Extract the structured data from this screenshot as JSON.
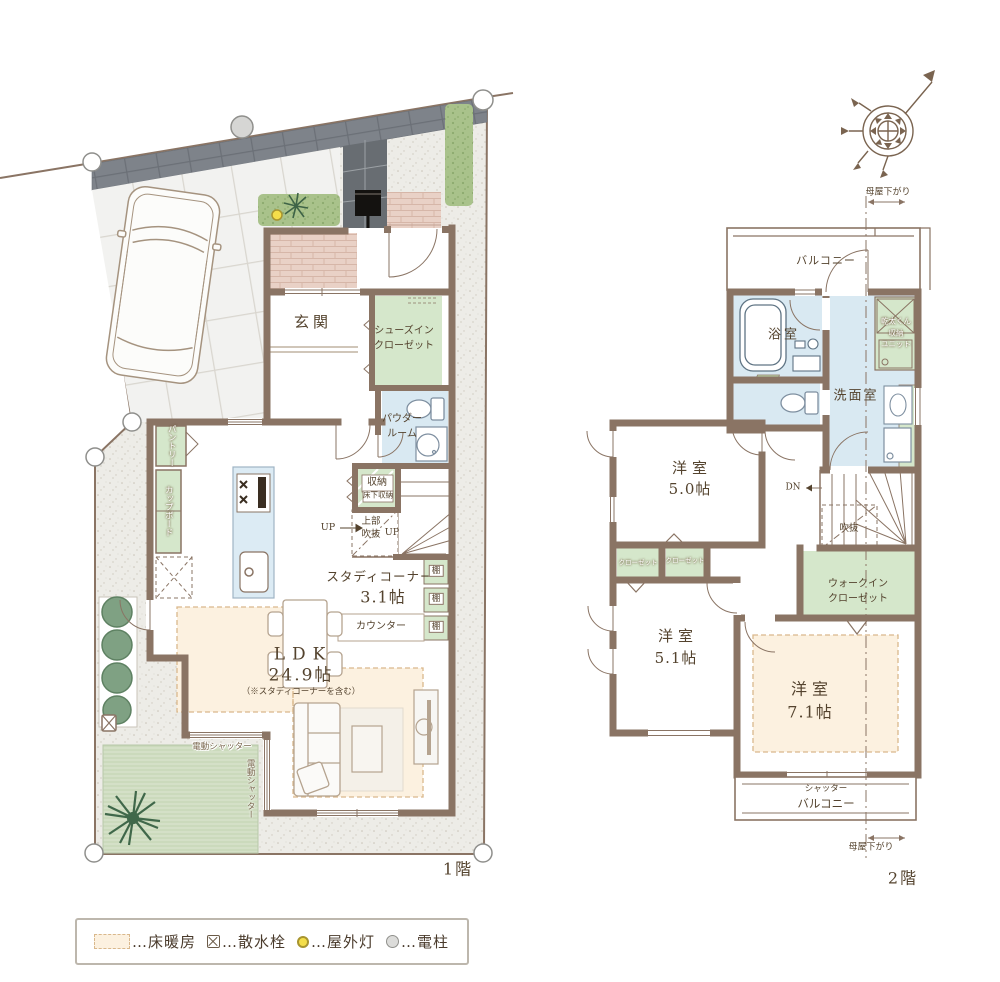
{
  "floor1": {
    "floor_label": "1階",
    "rooms": {
      "genkan": "玄関",
      "shoes_in_closet": "シューズイン\nクローゼット",
      "powder_room": "パウダー\nルーム",
      "storage": "収納",
      "underfloor_storage": "床下収納",
      "upper_void": "上部\n吹抜",
      "up": "UP",
      "study_corner": "スタディコーナー",
      "study_size": "3.1帖",
      "counter": "カウンター",
      "shelf": "棚",
      "pantry": "パントリー",
      "cupboard": "カップボード",
      "ldk": "LDK",
      "ldk_size": "24.9帖",
      "ldk_note": "（※スタディコーナーを含む）",
      "electric_shutter": "電動シャッター"
    }
  },
  "floor2": {
    "floor_label": "2階",
    "rooms": {
      "balcony": "バルコニー",
      "bathroom": "浴室",
      "dryer_unit": "乾太くん\n収納\nユニット",
      "washroom": "洗面室",
      "dn": "DN",
      "void": "吹抜",
      "bedroom_a": "洋室",
      "bedroom_a_size": "5.0帖",
      "closet": "クローゼット",
      "walk_in_closet": "ウォークイン\nクローゼット",
      "bedroom_b": "洋室",
      "bedroom_b_size": "5.1帖",
      "bedroom_c": "洋室",
      "bedroom_c_size": "7.1帖",
      "shutter_small": "シャッター",
      "shutter_balcony": "バルコニー",
      "moya_sagari": "母屋下がり"
    }
  },
  "legend": {
    "floor_heating": "…床暖房",
    "water_tap": "…散水栓",
    "outdoor_light": "…屋外灯",
    "utility_pole": "…電柱"
  }
}
